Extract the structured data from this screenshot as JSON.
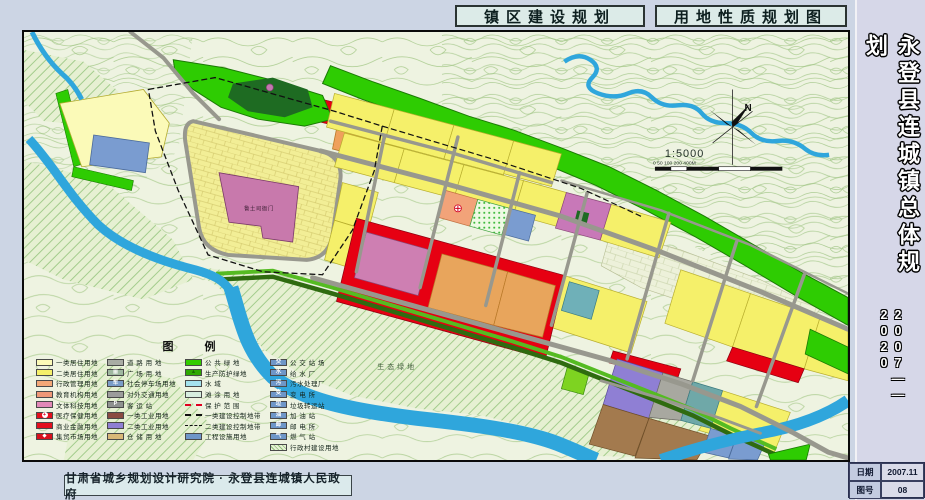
{
  "header": {
    "title_left": "镇区建设规划",
    "title_right": "用地性质规划图"
  },
  "sidebar": {
    "title": "永登县连城镇总体规划",
    "period": "2007——2020",
    "date_label": "日期",
    "date_value": "2007.11",
    "sheet_label": "图号",
    "sheet_value": "08"
  },
  "footer": {
    "credit": "甘肃省城乡规划设计研究院 · 永登县连城镇人民政府"
  },
  "map": {
    "north_label": "N",
    "scale_text": "1:5000",
    "scalebar_text": "0  50 100      200                  400M",
    "labels": {
      "historic_site": "鲁土司衙门",
      "eco_green": "生态绿地"
    },
    "colors": {
      "residential2": "#F5F06A",
      "residential1": "#FBFAB8",
      "commercial": "#E60012",
      "market_orange": "#E8A55C",
      "historic_pink": "#C879AC",
      "warehouse_brown": "#A37A4E",
      "industrial_purple": "#8F7FD4",
      "utility_blue": "#7A9CD0",
      "public_green": "#2ECC02",
      "water": "#2FA6DC",
      "road_gray": "#98988E"
    }
  },
  "legend": {
    "title": "图    例",
    "columns": [
      {
        "items": [
          {
            "label": "一类居住用地",
            "color": "#FBFAB8"
          },
          {
            "label": "二类居住用地",
            "color": "#F5F06A"
          },
          {
            "label": "行政管理用地",
            "color": "#F4A878"
          },
          {
            "label": "教育机构用地",
            "color": "#EF9878"
          },
          {
            "label": "文体科技用地",
            "color": "#E289B8"
          },
          {
            "label": "医疗保健用地",
            "color": "#E3101E",
            "symbol": "+",
            "symbol_color": "#e00020",
            "symbol_bg": "circ"
          },
          {
            "label": "商业金融用地",
            "color": "#E3101E"
          },
          {
            "label": "集贸市场用地",
            "color": "#D8101E",
            "symbol": "◆",
            "symbol_color": "#ffffff"
          }
        ]
      },
      {
        "items": [
          {
            "label": "道  路  用  地",
            "color": "#A9ACA4"
          },
          {
            "label": "广  场  用  地",
            "color": "#9FB8A0",
            "symbol": "▦",
            "symbol_color": "#ffffff"
          },
          {
            "label": "社会停车场用地",
            "color": "#7A9CC8",
            "symbol": "车",
            "symbol_color": "#ffffff"
          },
          {
            "label": "对外交通用地",
            "color": "#9C9C9C"
          },
          {
            "label": "客  运  站",
            "color": "#8F9290",
            "symbol": "P",
            "symbol_color": "#ffffff"
          },
          {
            "label": "一类工业用地",
            "color": "#8A4A42"
          },
          {
            "label": "二类工业用地",
            "color": "#8F7FD4"
          },
          {
            "label": "仓  储  用  地",
            "color": "#D8B878"
          }
        ]
      },
      {
        "items": [
          {
            "label": "公  共  绿  地",
            "color": "#33CC00"
          },
          {
            "label": "生产防护绿地",
            "color": "#2EA800",
            "symbol": "▲",
            "symbol_color": "#1a6a00"
          },
          {
            "label": "水          域",
            "color": "#A5E2EE"
          },
          {
            "label": "滩  涂  用  地",
            "color": "#D8EEE0"
          },
          {
            "label": "保  护  范  围",
            "type": "line",
            "style": "red-dashdot"
          },
          {
            "label": "一类建设控制地带",
            "type": "line",
            "style": "black-dashdot"
          },
          {
            "label": "二类建设控制地带",
            "type": "line",
            "style": "black-dash"
          },
          {
            "label": "工程设施用地",
            "color": "#6E96C8"
          }
        ]
      },
      {
        "items": [
          {
            "label": "公 交 站 场",
            "color": "#6E96C8",
            "symbol": "交",
            "symbol_color": "#ffffff"
          },
          {
            "label": "给  水  厂",
            "color": "#6E96C8",
            "symbol": "水",
            "symbol_color": "#ffffff"
          },
          {
            "label": "污水处理厂",
            "color": "#6E96C8",
            "symbol": "污",
            "symbol_color": "#ffffff"
          },
          {
            "label": "变  电  所",
            "color": "#6E96C8",
            "symbol": "变",
            "symbol_color": "#ffffff"
          },
          {
            "label": "垃圾转运站",
            "color": "#6E96C8",
            "symbol": "垃",
            "symbol_color": "#ffffff"
          },
          {
            "label": "加  油  站",
            "color": "#6E96C8",
            "symbol": "油",
            "symbol_color": "#ffffff"
          },
          {
            "label": "邮  电  所",
            "color": "#6E96C8",
            "symbol": "邮",
            "symbol_color": "#ffffff"
          },
          {
            "label": "燃  气  站",
            "color": "#6E96C8",
            "symbol": "气",
            "symbol_color": "#ffffff"
          },
          {
            "label": "行政村建设用地",
            "type": "hatch"
          }
        ]
      }
    ]
  }
}
